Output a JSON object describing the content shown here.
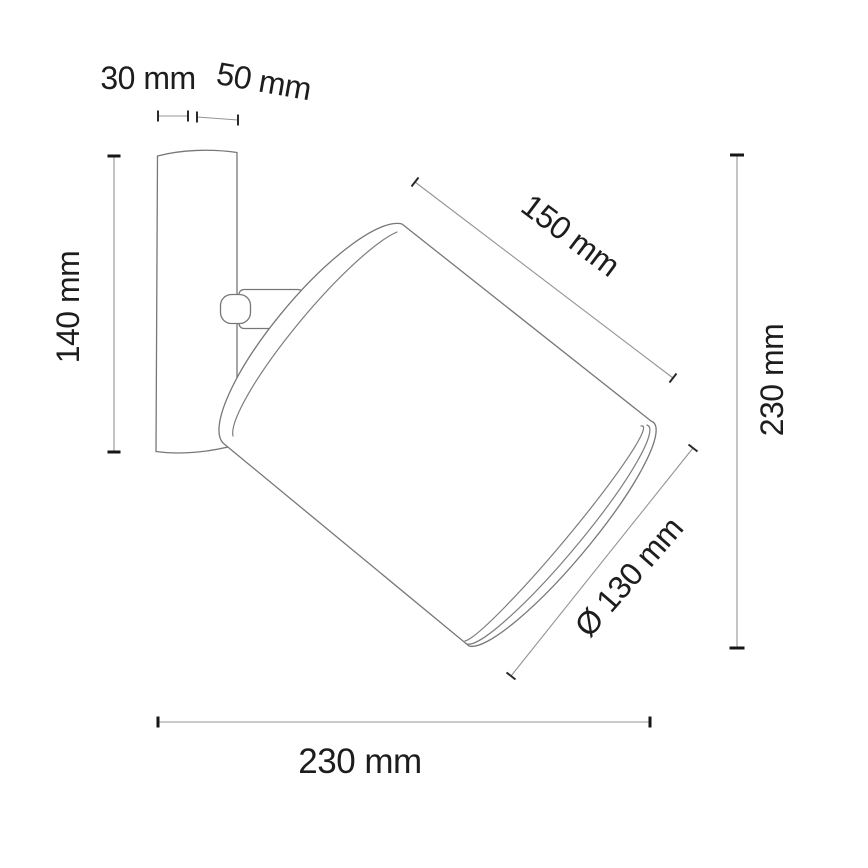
{
  "drawing": {
    "kind": "technical dimension diagram",
    "subject": "wall-mounted spotlight with cylindrical shade",
    "background": "#ffffff",
    "line_color": "#777777",
    "dimension_line_color": "#949494",
    "tick_color": "#161616",
    "text_color": "#1d1d1d"
  },
  "labels": {
    "bracket_depth": "30 mm",
    "arm_length": "50 mm",
    "bracket_height": "140 mm",
    "shade_length": "150 mm",
    "overall_height": "230 mm",
    "shade_diameter": "Ø 130 mm",
    "overall_depth": "230 mm"
  }
}
